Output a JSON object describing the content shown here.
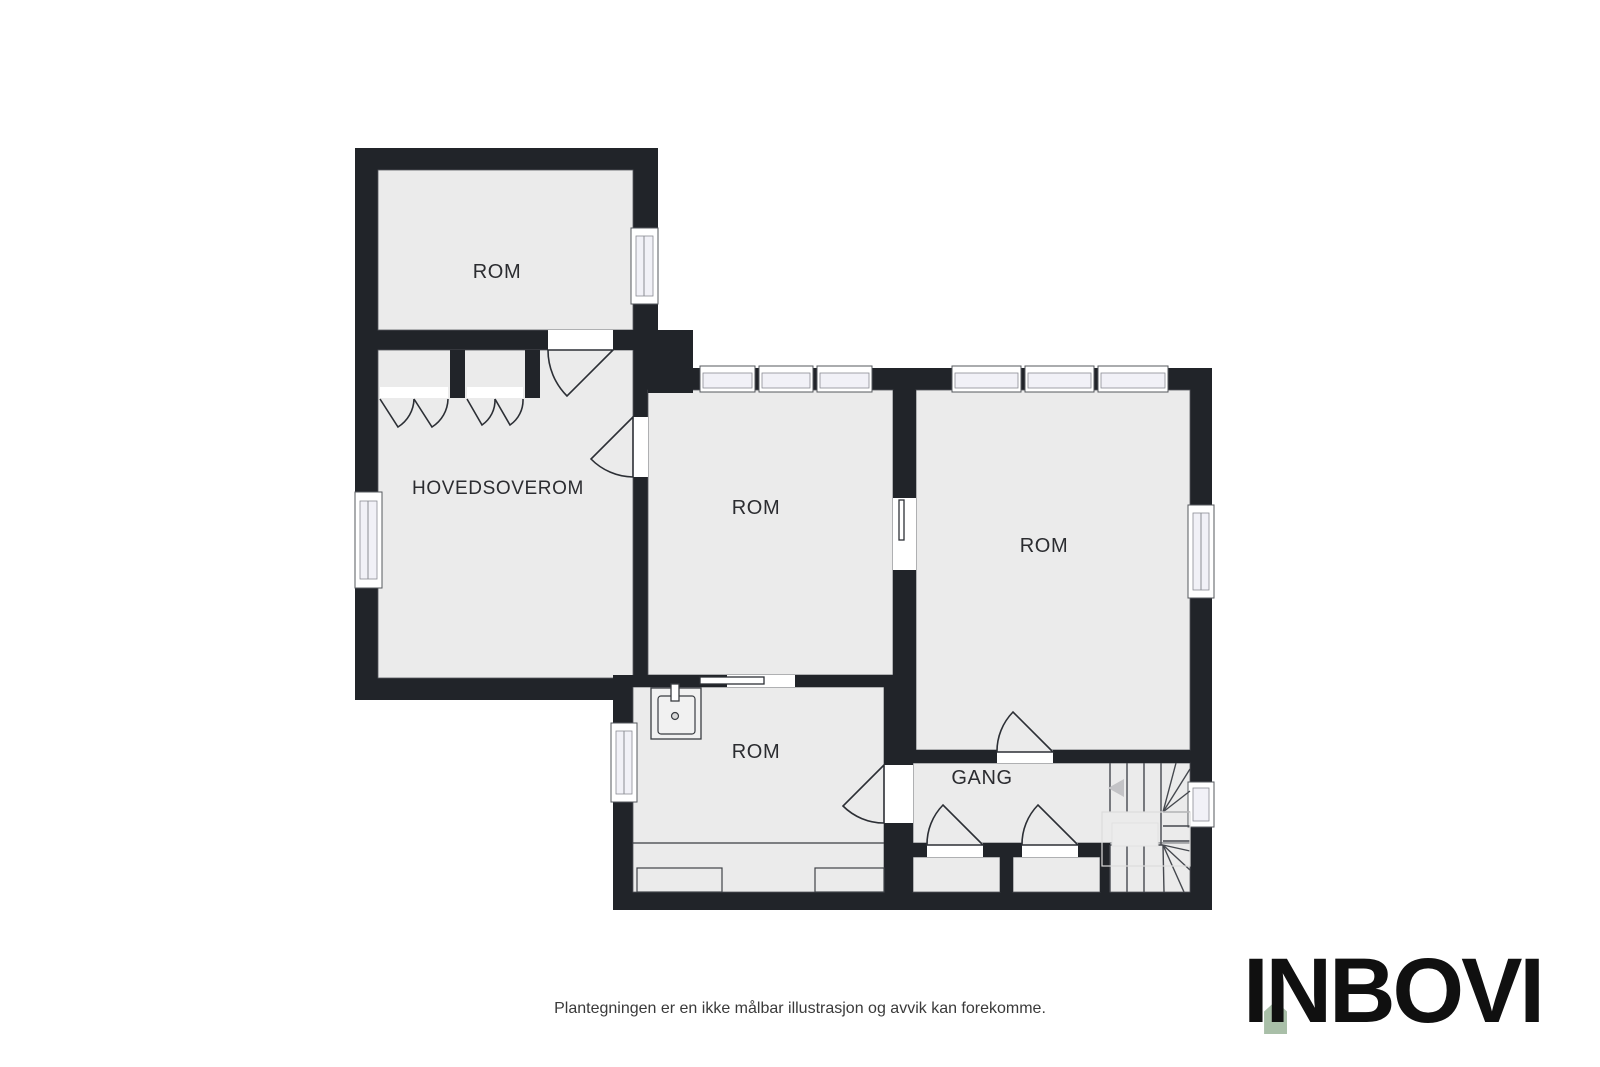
{
  "plan": {
    "rooms": {
      "top_left_room": {
        "label": "ROM"
      },
      "master_bedroom": {
        "label": "HOVEDSOVEROM"
      },
      "middle_room": {
        "label": "ROM"
      },
      "right_room": {
        "label": "ROM"
      },
      "bottom_room": {
        "label": "ROM"
      },
      "hallway": {
        "label": "GANG"
      }
    },
    "features": [
      "stairs-with-left-up-arrow",
      "sink",
      "wardrobes",
      "window-bands"
    ]
  },
  "footer": {
    "disclaimer": "Plantegningen er en ikke målbar illustrasjon og avvik kan forekomme.",
    "logo_text": "INBOVI"
  },
  "colors": {
    "wall": "#212429",
    "room_fill": "#ebebeb",
    "window_pane": "#f1f1f7",
    "logo_accent": "#a9bfa8",
    "background": "#ffffff"
  }
}
